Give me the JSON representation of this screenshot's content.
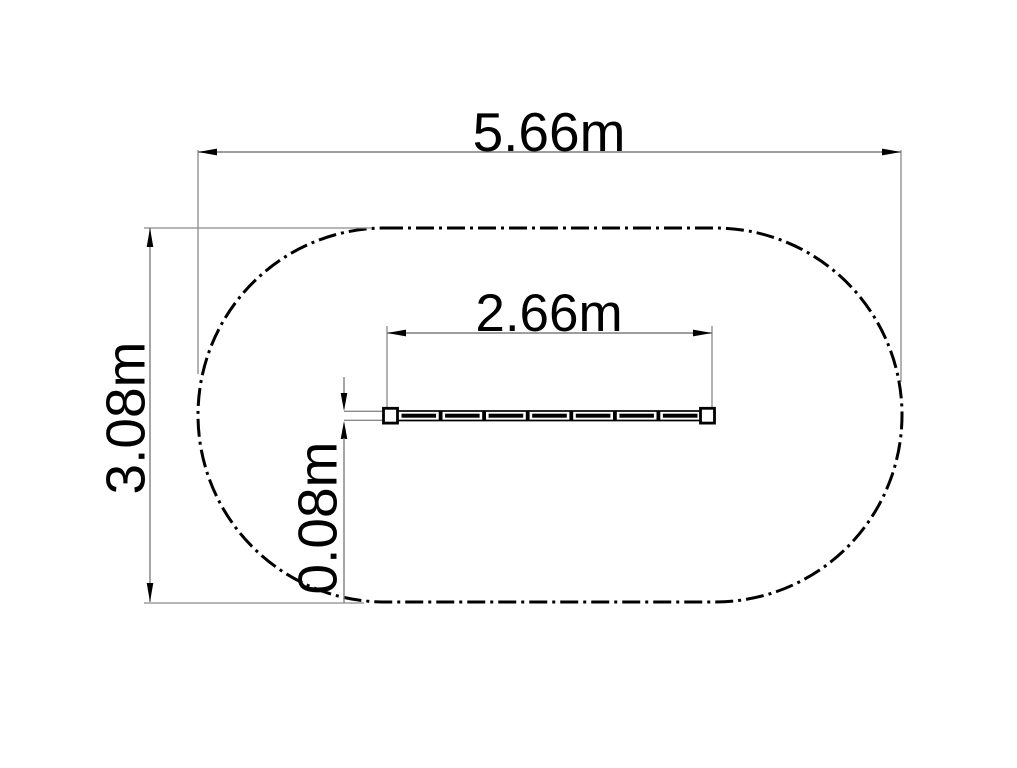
{
  "drawing": {
    "dimensions": {
      "overall_width": {
        "label": "5.66m",
        "value": 5.66,
        "unit": "m"
      },
      "overall_height": {
        "label": "3.08m",
        "value": 3.08,
        "unit": "m"
      },
      "bar_length": {
        "label": "2.66m",
        "value": 2.66,
        "unit": "m"
      },
      "bar_thickness": {
        "label": "0.08m",
        "value": 0.08,
        "unit": "m"
      }
    },
    "colors": {
      "geometry": "#000000",
      "dimension_lines": "#7f7f7f",
      "text": "#000000",
      "background": "#ffffff"
    }
  }
}
